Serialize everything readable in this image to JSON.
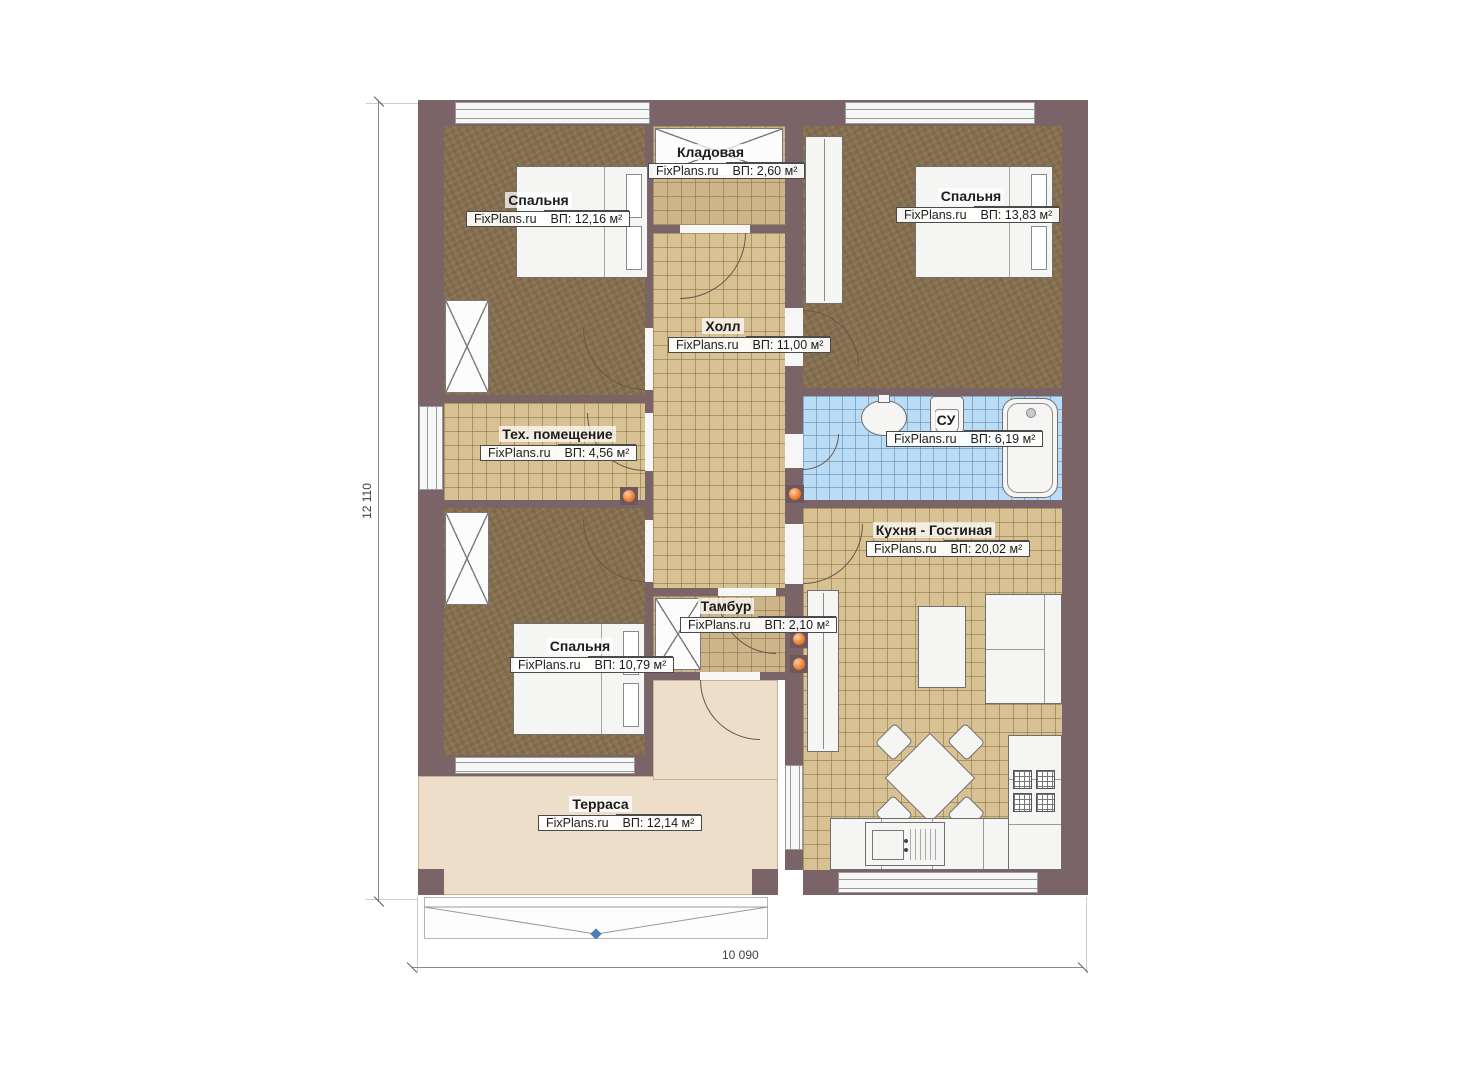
{
  "plan": {
    "brand": "FixPlans.ru",
    "rooms": [
      {
        "key": "bedroom-1",
        "name": "Спальня",
        "area": "ВП: 12,16 м²"
      },
      {
        "key": "storage",
        "name": "Кладовая",
        "area": "ВП: 2,60 м²"
      },
      {
        "key": "bedroom-2",
        "name": "Спальня",
        "area": "ВП: 13,83 м²"
      },
      {
        "key": "hall",
        "name": "Холл",
        "area": "ВП: 11,00 м²"
      },
      {
        "key": "tech-room",
        "name": "Тех. помещение",
        "area": "ВП: 4,56 м²"
      },
      {
        "key": "bathroom",
        "name": "СУ",
        "area": "ВП: 6,19 м²"
      },
      {
        "key": "kitchen-living",
        "name": "Кухня - Гостиная",
        "area": "ВП: 20,02 м²"
      },
      {
        "key": "vestibule",
        "name": "Тамбур",
        "area": "ВП: 2,10 м²"
      },
      {
        "key": "bedroom-3",
        "name": "Спальня",
        "area": "ВП: 10,79 м²"
      },
      {
        "key": "terrace",
        "name": "Терраса",
        "area": "ВП: 12,14 м²"
      }
    ],
    "dimensions": {
      "vertical": "12 110",
      "horizontal": "10 090"
    },
    "colors": {
      "wall": "#7b6468",
      "carpet": "#877050",
      "tile": "#d8c193",
      "tile_dark": "#cdb489",
      "bath_tile": "#badcf4",
      "terrace": "#eddec9",
      "radiator": "#ef8036",
      "entry_marker": "#4a7fb5"
    }
  }
}
